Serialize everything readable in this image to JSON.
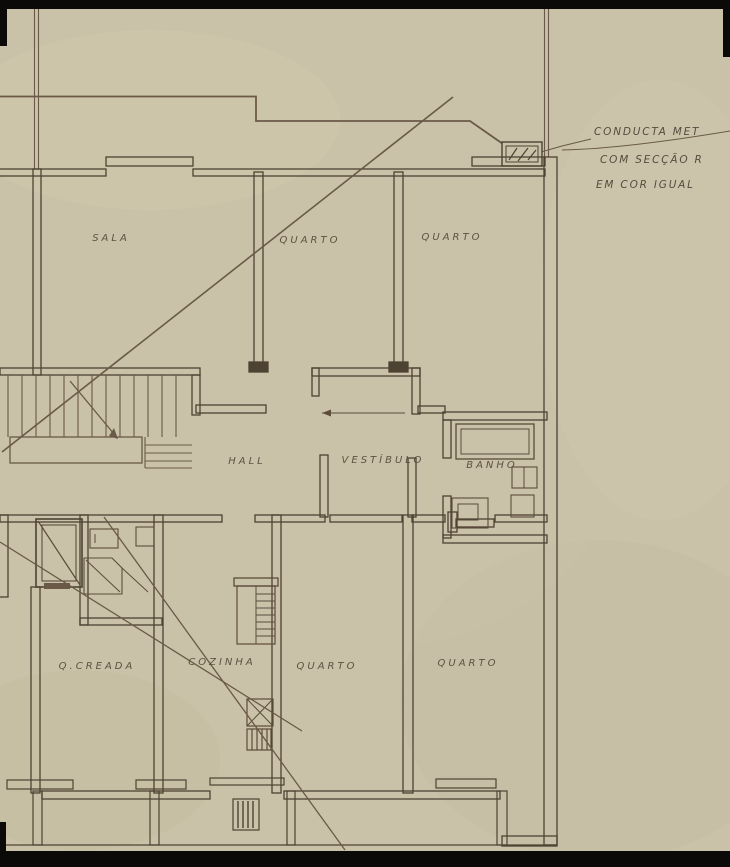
{
  "meta": {
    "title": "Scanned architectural floor plan (aged paper, hand-drawn ink)"
  },
  "colors": {
    "paper": "#c9c2a8",
    "ink_wall": "#4e4232",
    "ink_light": "#6a5947",
    "label_ink": "#4f4335",
    "scan_edge": "#0b0a08"
  },
  "rooms": {
    "sala": "SALA",
    "quarto_top_left": "QUARTO",
    "quarto_top_right": "QUARTO",
    "hall": "HALL",
    "vestibulo": "VESTÍBULO",
    "banho": "BANHO",
    "q_creada": "Q.CREADA",
    "cozinha": "COZINHA",
    "quarto_bottom_left": "QUARTO",
    "quarto_bottom_right": "QUARTO"
  },
  "annotation": {
    "line1": "CONDUCTA MET",
    "line2": "COM SECÇÃO R",
    "line3": "EM COR IGUAL"
  }
}
